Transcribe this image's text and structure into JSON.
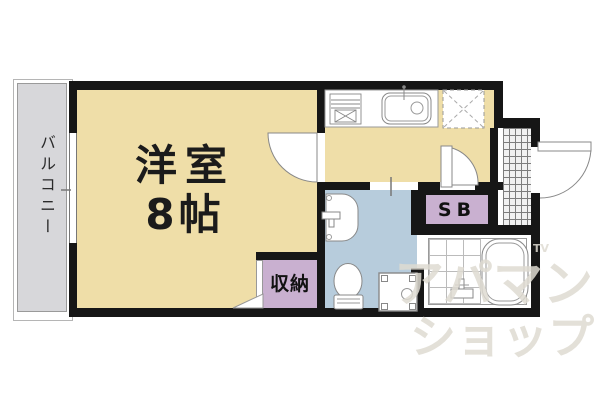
{
  "plan": {
    "rooms": {
      "main": {
        "name": "洋室",
        "size": "8帖"
      },
      "balcony": {
        "label": "バルコニー"
      },
      "closet": {
        "label": "収納"
      },
      "shoebox": {
        "label": "SB"
      }
    },
    "watermark": {
      "line1": "アパマン",
      "line2": "ショップ",
      "tm": "TV"
    }
  },
  "colors": {
    "room_floor": "#EFDEA8",
    "wet_floor": "#B7CCDC",
    "storage_fill": "#C9B0D0",
    "balcony_fill": "#D7D7DA",
    "wall": "#161616",
    "line": "#888888",
    "watermark": "rgba(222,218,209,0.85)"
  }
}
